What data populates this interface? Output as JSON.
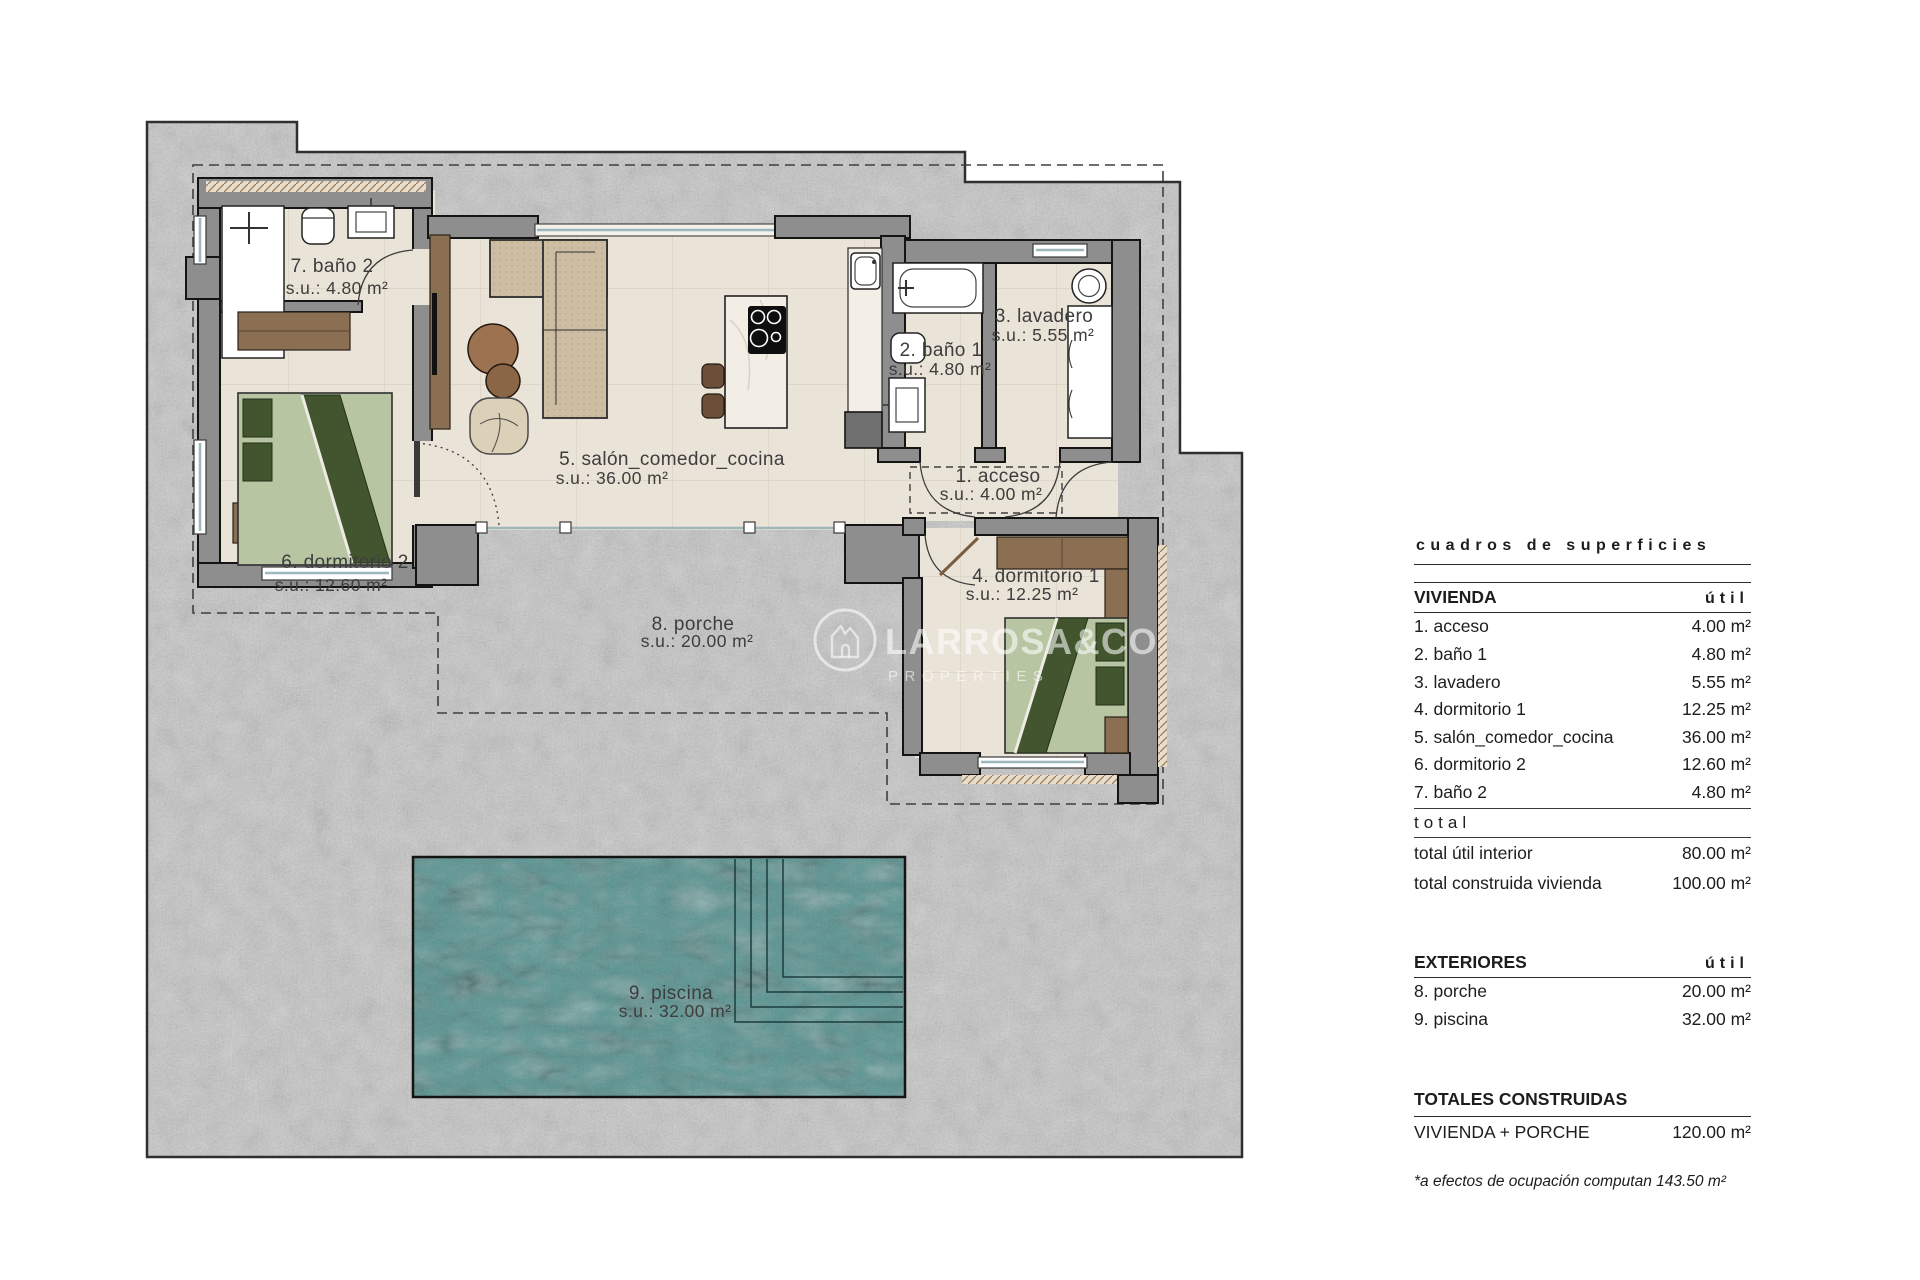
{
  "plan": {
    "rooms": [
      {
        "label": "7. baño 2",
        "su": "s.u.: 4.80 m²"
      },
      {
        "label": "6. dormitorio 2",
        "su": "s.u.: 12.60 m²"
      },
      {
        "label": "5. salón_comedor_cocina",
        "su": "s.u.: 36.00 m²"
      },
      {
        "label": "2. baño 1",
        "su": "s.u.: 4.80 m²"
      },
      {
        "label": "3. lavadero",
        "su": "s.u.: 5.55 m²"
      },
      {
        "label": "1. acceso",
        "su": "s.u.: 4.00 m²"
      },
      {
        "label": "4. dormitorio 1",
        "su": "s.u.: 12.25 m²"
      },
      {
        "label": "8. porche",
        "su": "s.u.: 20.00 m²"
      },
      {
        "label": "9. piscina",
        "su": "s.u.: 32.00 m²"
      }
    ],
    "watermark": {
      "brand": "LARROSA&CO",
      "tagline": "PROPERTIES"
    },
    "colors": {
      "plot": "#c6c6c6",
      "wall": "#8e8e8e",
      "wall_outline": "#141414",
      "floor": "#eae3d7",
      "pool": "#569491",
      "wood": "#8a6f52",
      "wood_dark": "#6b4f39",
      "sofa": "#cdbda2",
      "bed_light": "#b7c5a2",
      "bed_dark": "#42552e",
      "fixture": "#ffffff",
      "label_text": "#3d3d3d"
    }
  },
  "table": {
    "title": "cuadros de superficies",
    "vivienda": {
      "header": "VIVIENDA",
      "unit": "útil",
      "rows": [
        {
          "label": "1. acceso",
          "value": "4.00 m²"
        },
        {
          "label": "2. baño 1",
          "value": "4.80 m²"
        },
        {
          "label": "3. lavadero",
          "value": "5.55 m²"
        },
        {
          "label": "4. dormitorio 1",
          "value": "12.25 m²"
        },
        {
          "label": "5. salón_comedor_cocina",
          "value": "36.00 m²"
        },
        {
          "label": "6. dormitorio 2",
          "value": "12.60 m²"
        },
        {
          "label": "7. baño 2",
          "value": "4.80 m²"
        }
      ],
      "total_word": "total",
      "totals": [
        {
          "label": "total útil interior",
          "value": "80.00 m²"
        },
        {
          "label": "total construida vivienda",
          "value": "100.00 m²"
        }
      ]
    },
    "exteriores": {
      "header": "EXTERIORES",
      "unit": "útil",
      "rows": [
        {
          "label": "8. porche",
          "value": "20.00 m²"
        },
        {
          "label": "9. piscina",
          "value": "32.00 m²"
        }
      ]
    },
    "totales": {
      "header": "TOTALES CONSTRUIDAS",
      "rows": [
        {
          "label": "VIVIENDA + PORCHE",
          "value": "120.00 m²"
        }
      ]
    },
    "footnote": "*a efectos de ocupación computan 143.50 m²"
  }
}
